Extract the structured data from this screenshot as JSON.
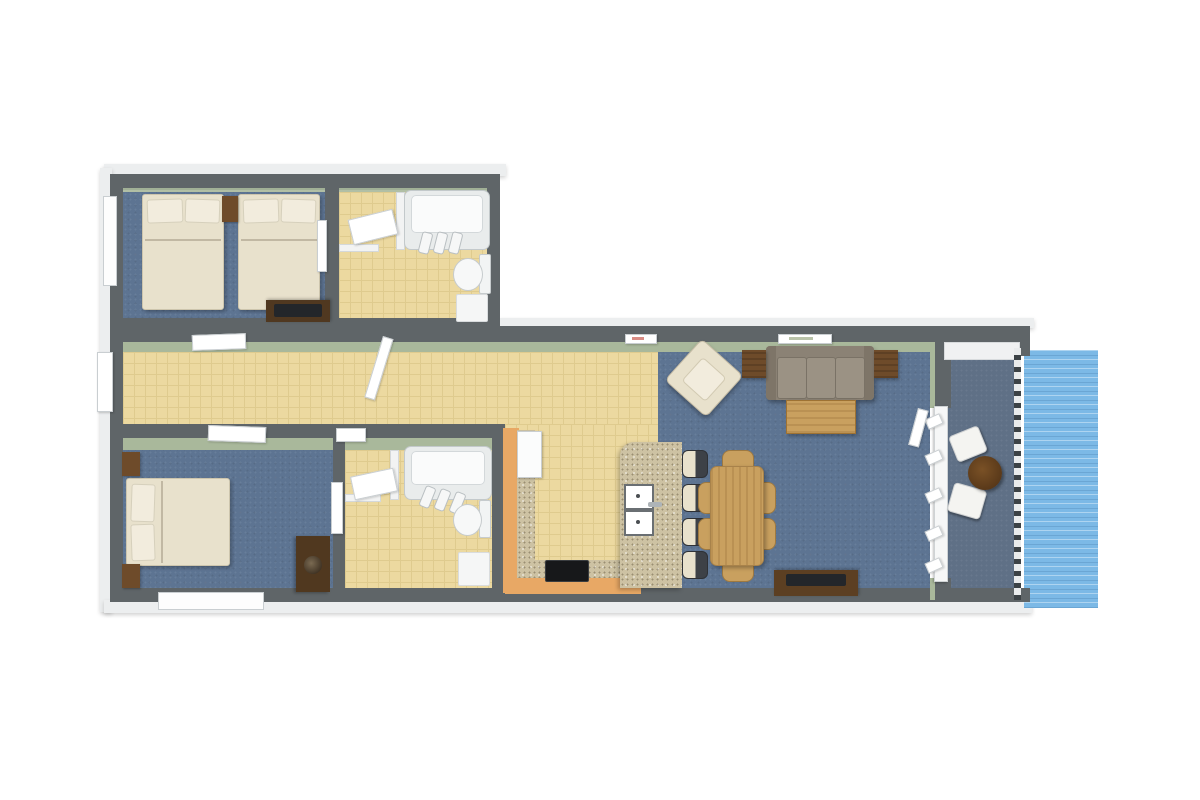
{
  "meta": {
    "type": "3d-floor-plan-render",
    "view": "top-down isometric",
    "description": "Two-bedroom, two-bathroom waterfront apartment floor plan with open kitchen, dining and living area, and a balcony overlooking water",
    "visible_text": "none"
  },
  "colors": {
    "wall-top": "#5f6568",
    "wall-outer": "#eceeef",
    "wall-sage": "#a9b89b",
    "tile-yellow": "#ecd9a0",
    "tile-line": "#dfcb8e",
    "carpet-blue": "#5d7492",
    "balcony-floor": "#5f7086",
    "water-blue": "#7cb9e6",
    "granite": "#cdc2a3",
    "wood-mid": "#c9a05f",
    "wood-brown": "#6e4b2a",
    "dark-brown": "#3f2d1c",
    "cream": "#e8e1cc",
    "cream-light": "#f2ecdd",
    "sofa-gray": "#8b8275",
    "sofa-light": "#9b9284",
    "stool-dark": "#3d4147",
    "tv-dark": "#23262a",
    "fixture-outline": "#c9ced1",
    "railing-dark": "#3c4246"
  },
  "rooms": [
    {
      "id": "bedroom-1",
      "label": "Bedroom 1 (twin double beds)",
      "floor": "blue carpet",
      "furniture": [
        "double bed x2",
        "nightstand",
        "dresser with TV"
      ],
      "openings": [
        "window on left wall",
        "door to hallway"
      ]
    },
    {
      "id": "bathroom-1",
      "label": "Bathroom 1",
      "floor": "yellow tile",
      "furniture": [
        "closet",
        "bathtub",
        "toilet",
        "bath mat"
      ],
      "openings": [
        "door to hallway"
      ]
    },
    {
      "id": "hallway",
      "label": "Hallway",
      "floor": "yellow tile",
      "furniture": [],
      "openings": [
        "entry door at left end"
      ]
    },
    {
      "id": "bedroom-2",
      "label": "Bedroom 2 (double bed)",
      "floor": "blue carpet",
      "furniture": [
        "double bed",
        "nightstand x2",
        "dresser with lamp"
      ],
      "openings": [
        "door to hallway",
        "window on bottom wall"
      ]
    },
    {
      "id": "bathroom-2",
      "label": "Bathroom 2",
      "floor": "yellow tile",
      "furniture": [
        "closet",
        "bathtub",
        "toilet",
        "bath mat"
      ],
      "openings": [
        "door to bedroom side"
      ]
    },
    {
      "id": "kitchen",
      "label": "Kitchen",
      "floor": "yellow tile",
      "furniture": [
        "refrigerator",
        "L-shaped granite counter",
        "stove",
        "granite island with double sink",
        "bar stool x4"
      ]
    },
    {
      "id": "dining-area",
      "label": "Dining area",
      "floor": "blue carpet",
      "furniture": [
        "wooden dining table",
        "dining chair x6",
        "desk with TV"
      ]
    },
    {
      "id": "living-area",
      "label": "Living area",
      "floor": "blue carpet",
      "furniture": [
        "three-seat sofa",
        "end table x2",
        "coffee table",
        "armchair",
        "wall art x2"
      ]
    },
    {
      "id": "balcony",
      "label": "Balcony / deck",
      "floor": "blue-gray decking",
      "furniture": [
        "round bistro table",
        "deck chair x2"
      ],
      "openings": [
        "sliding glass doors",
        "railing on water side"
      ]
    },
    {
      "id": "waterfront",
      "label": "Water",
      "floor": "water",
      "furniture": [],
      "openings": []
    }
  ]
}
